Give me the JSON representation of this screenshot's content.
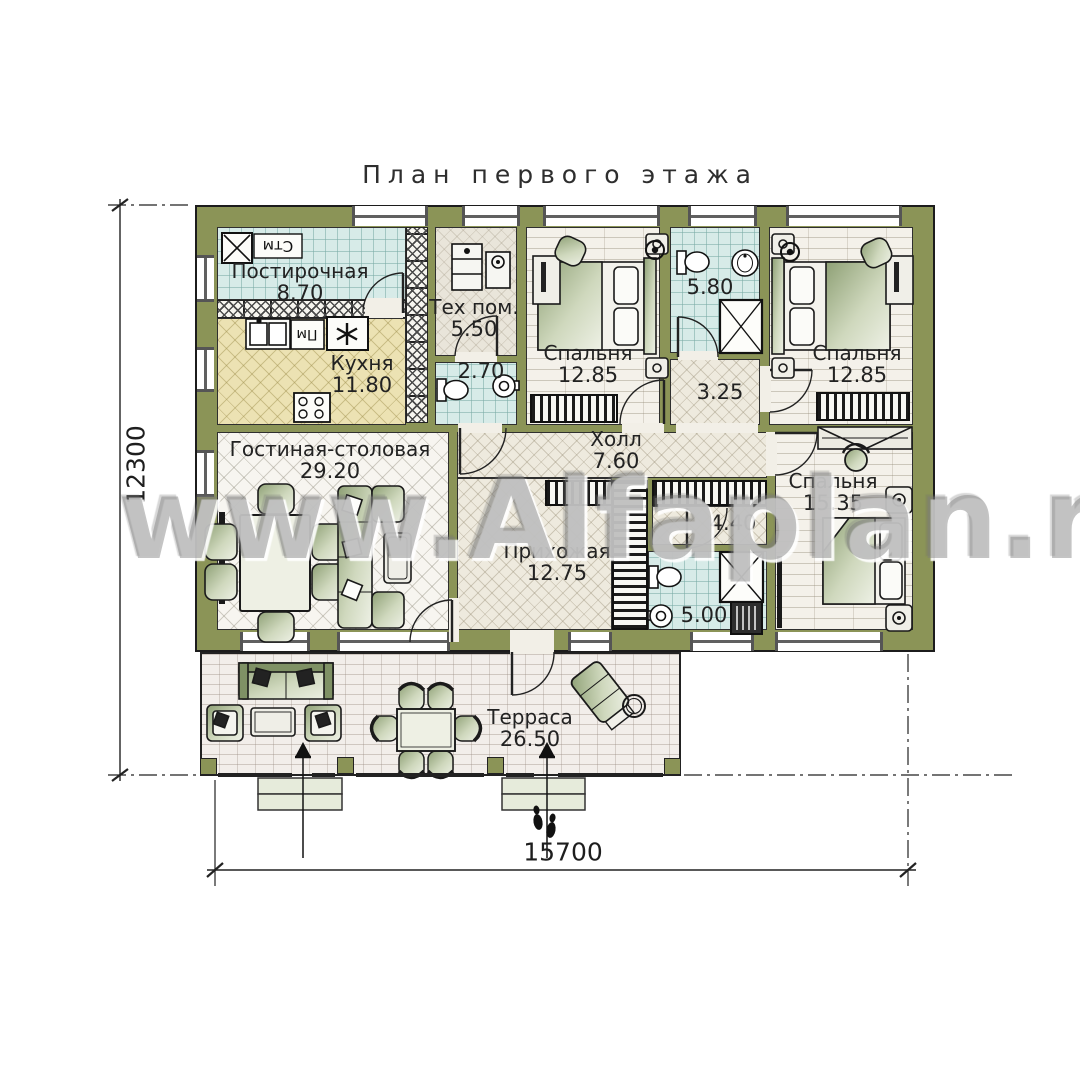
{
  "title": "План первого этажа",
  "watermark": "www.Alfaplan.ru",
  "dimensions": {
    "overall_width": "15700",
    "overall_depth": "12300"
  },
  "rooms": {
    "laundry": {
      "name": "Постирочная",
      "area": "8.70"
    },
    "kitchen": {
      "name": "Кухня",
      "area": "11.80"
    },
    "tech": {
      "name": "Тех пом.",
      "area": "5.50"
    },
    "wc": {
      "area": "2.70"
    },
    "bedroom1": {
      "name": "Спальня",
      "area": "12.85"
    },
    "bath1": {
      "area": "5.80"
    },
    "lobby": {
      "area": "3.25"
    },
    "bedroom2": {
      "name": "Спальня",
      "area": "12.85"
    },
    "living": {
      "name": "Гостиная-столовая",
      "area": "29.20"
    },
    "hall": {
      "name": "Холл",
      "area": "7.60"
    },
    "entry": {
      "name": "Прихожая",
      "area": "12.75"
    },
    "closet": {
      "area": "4.40"
    },
    "bath2": {
      "area": "5.00"
    },
    "bedroom3": {
      "name": "Спальня",
      "area": "15.35"
    },
    "terrace": {
      "name": "Терраса",
      "area": "26.50"
    }
  },
  "appliances": {
    "washer": "Стм",
    "dishwasher": "Пм"
  },
  "colors": {
    "wall": "#8b9457",
    "outline": "#1c1c1c",
    "water_floor": "#d7ebe8",
    "kitchen_floor": "#ece2b3",
    "cream_floor": "#eeeade",
    "living_floor": "#f7f5f0",
    "plank_floor": "#f4f1ea",
    "terrace_floor": "#f2eeea",
    "furniture_green": "#9dad82",
    "step_fill": "#e6ebdb"
  }
}
